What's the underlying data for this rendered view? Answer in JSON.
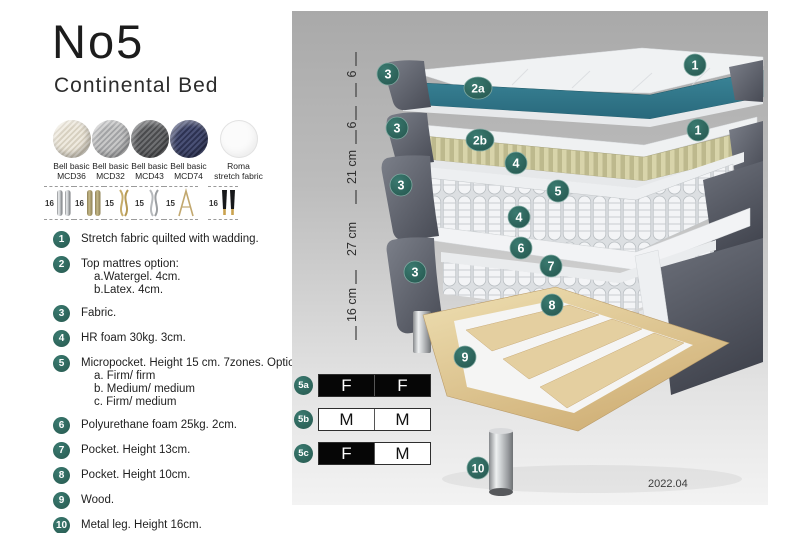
{
  "header": {
    "title": "No5",
    "subtitle": "Continental Bed"
  },
  "fabrics": [
    {
      "name": "Bell basic",
      "code": "MCD36"
    },
    {
      "name": "Bell basic",
      "code": "MCD32"
    },
    {
      "name": "Bell basic",
      "code": "MCD43"
    },
    {
      "name": "Bell basic",
      "code": "MCD74"
    },
    {
      "name": "Roma",
      "code": "stretch fabric"
    }
  ],
  "legs": [
    {
      "height": "16",
      "type": "chrome-cylinder"
    },
    {
      "height": "16",
      "type": "wood-cylinder"
    },
    {
      "height": "15",
      "type": "gold-twist"
    },
    {
      "height": "15",
      "type": "silver-twist"
    },
    {
      "height": "15",
      "type": "hairpin"
    },
    {
      "height": "16",
      "type": "black-gold-cone"
    }
  ],
  "features": [
    {
      "num": "1",
      "lines": [
        "Stretch fabric quilted with wadding."
      ]
    },
    {
      "num": "2",
      "lines": [
        "Top mattres option:",
        "a.Watergel. 4cm.",
        "b.Latex. 4cm."
      ]
    },
    {
      "num": "3",
      "lines": [
        "Fabric."
      ]
    },
    {
      "num": "4",
      "lines": [
        "HR foam 30kg. 3cm."
      ]
    },
    {
      "num": "5",
      "lines": [
        "Micropocket. Height 15 cm. 7zones. Option:",
        "a. Firm/ firm",
        "b. Medium/ medium",
        "c. Firm/ medium"
      ]
    },
    {
      "num": "6",
      "lines": [
        "Polyurethane foam 25kg. 2cm."
      ]
    },
    {
      "num": "7",
      "lines": [
        "Pocket. Height 13cm."
      ]
    },
    {
      "num": "8",
      "lines": [
        "Pocket. Height 10cm."
      ]
    },
    {
      "num": "9",
      "lines": [
        "Wood."
      ]
    },
    {
      "num": "10",
      "lines": [
        "Metal leg. Height 16cm."
      ]
    }
  ],
  "diagram": {
    "measurements": [
      "6",
      "6",
      "21 cm",
      "27 cm",
      "16 cm"
    ],
    "badges": [
      "1",
      "3",
      "2a",
      "1",
      "3",
      "2b",
      "4",
      "3",
      "5",
      "4",
      "6",
      "3",
      "7",
      "8",
      "9",
      "10"
    ]
  },
  "firmness": {
    "rows": [
      {
        "badge": "5a",
        "cells": [
          {
            "label": "F",
            "filled": true
          },
          {
            "label": "F",
            "filled": true
          }
        ]
      },
      {
        "badge": "5b",
        "cells": [
          {
            "label": "M",
            "filled": false
          },
          {
            "label": "M",
            "filled": false
          }
        ]
      },
      {
        "badge": "5c",
        "cells": [
          {
            "label": "F",
            "filled": true
          },
          {
            "label": "M",
            "filled": false
          }
        ]
      }
    ]
  },
  "footer": {
    "date": "2022.04"
  },
  "colors": {
    "badge_teal": "#2d6a62",
    "watergel_teal": "#2f7888",
    "latex_tan": "#d5d1a6",
    "shell_gray": "#5b5f69",
    "wood": "#dfc394",
    "panel_top": "#a9a9a9",
    "panel_bottom": "#f3f3f3"
  }
}
